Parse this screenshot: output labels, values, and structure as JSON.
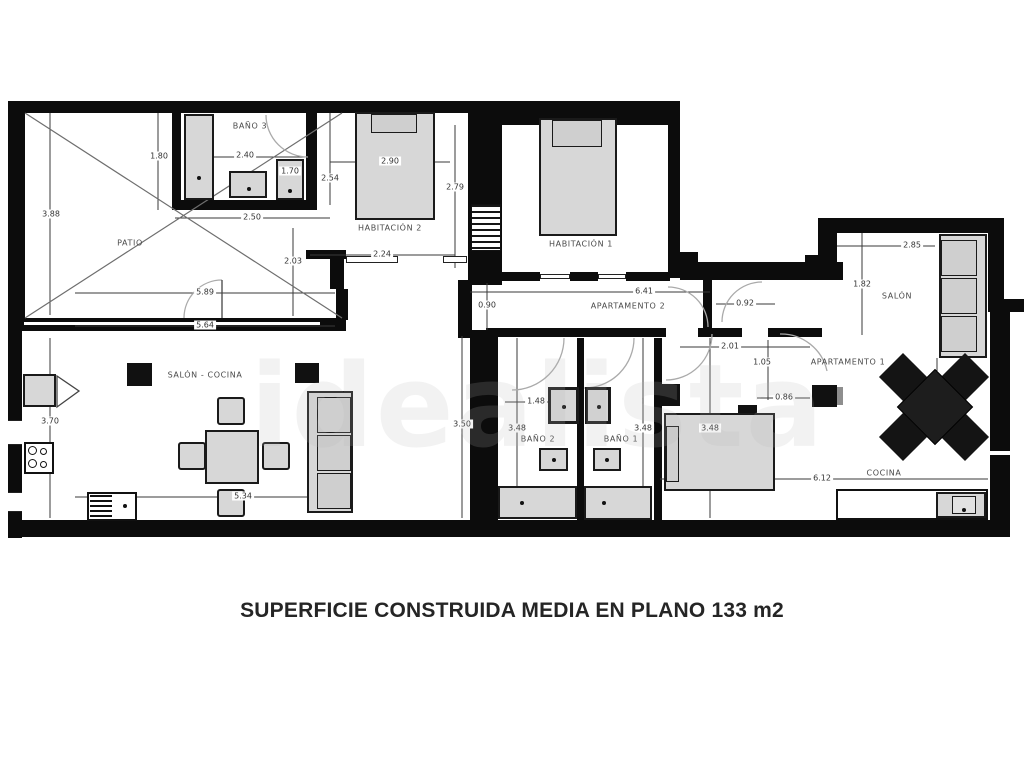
{
  "caption": "SUPERFICIE CONSTRUIDA MEDIA EN PLANO 133 m2",
  "watermark": "idealista",
  "rooms": [
    {
      "label": "PATIO",
      "x": 130,
      "y": 243
    },
    {
      "label": "BAÑO 3",
      "x": 250,
      "y": 126
    },
    {
      "label": "HABITACIÓN 2",
      "x": 390,
      "y": 228
    },
    {
      "label": "HABITACIÓN 1",
      "x": 581,
      "y": 244
    },
    {
      "label": "APARTAMENTO 2",
      "x": 628,
      "y": 306
    },
    {
      "label": "SALÓN - COCINA",
      "x": 205,
      "y": 375
    },
    {
      "label": "SALÓN",
      "x": 897,
      "y": 296
    },
    {
      "label": "APARTAMENTO 1",
      "x": 848,
      "y": 362
    },
    {
      "label": "BAÑO 2",
      "x": 538,
      "y": 439
    },
    {
      "label": "BAÑO 1",
      "x": 621,
      "y": 439
    },
    {
      "label": "COCINA",
      "x": 884,
      "y": 473
    }
  ],
  "dimensions": [
    {
      "value": "3.88",
      "x": 51,
      "y": 214
    },
    {
      "value": "1.80",
      "x": 159,
      "y": 156
    },
    {
      "value": "2.40",
      "x": 245,
      "y": 155
    },
    {
      "value": "1.70",
      "x": 290,
      "y": 171
    },
    {
      "value": "2.54",
      "x": 330,
      "y": 178
    },
    {
      "value": "2.90",
      "x": 390,
      "y": 161
    },
    {
      "value": "2.79",
      "x": 455,
      "y": 187
    },
    {
      "value": "2.50",
      "x": 252,
      "y": 217
    },
    {
      "value": "2.03",
      "x": 293,
      "y": 261
    },
    {
      "value": "5.89",
      "x": 205,
      "y": 292
    },
    {
      "value": "5.64",
      "x": 205,
      "y": 325
    },
    {
      "value": "2.24",
      "x": 382,
      "y": 254
    },
    {
      "value": "0.90",
      "x": 487,
      "y": 305
    },
    {
      "value": "6.41",
      "x": 644,
      "y": 291
    },
    {
      "value": "0.92",
      "x": 745,
      "y": 303
    },
    {
      "value": "2.85",
      "x": 912,
      "y": 245
    },
    {
      "value": "1.82",
      "x": 862,
      "y": 284
    },
    {
      "value": "2.01",
      "x": 730,
      "y": 346
    },
    {
      "value": "1.05",
      "x": 762,
      "y": 362
    },
    {
      "value": "0.86",
      "x": 784,
      "y": 397
    },
    {
      "value": "3.70",
      "x": 50,
      "y": 421
    },
    {
      "value": "3.50",
      "x": 462,
      "y": 424
    },
    {
      "value": "1.48",
      "x": 536,
      "y": 401
    },
    {
      "value": "3.48",
      "x": 517,
      "y": 428
    },
    {
      "value": "3.48",
      "x": 643,
      "y": 428
    },
    {
      "value": "3.48",
      "x": 710,
      "y": 428
    },
    {
      "value": "5.34",
      "x": 243,
      "y": 496
    },
    {
      "value": "6.12",
      "x": 822,
      "y": 478
    }
  ]
}
